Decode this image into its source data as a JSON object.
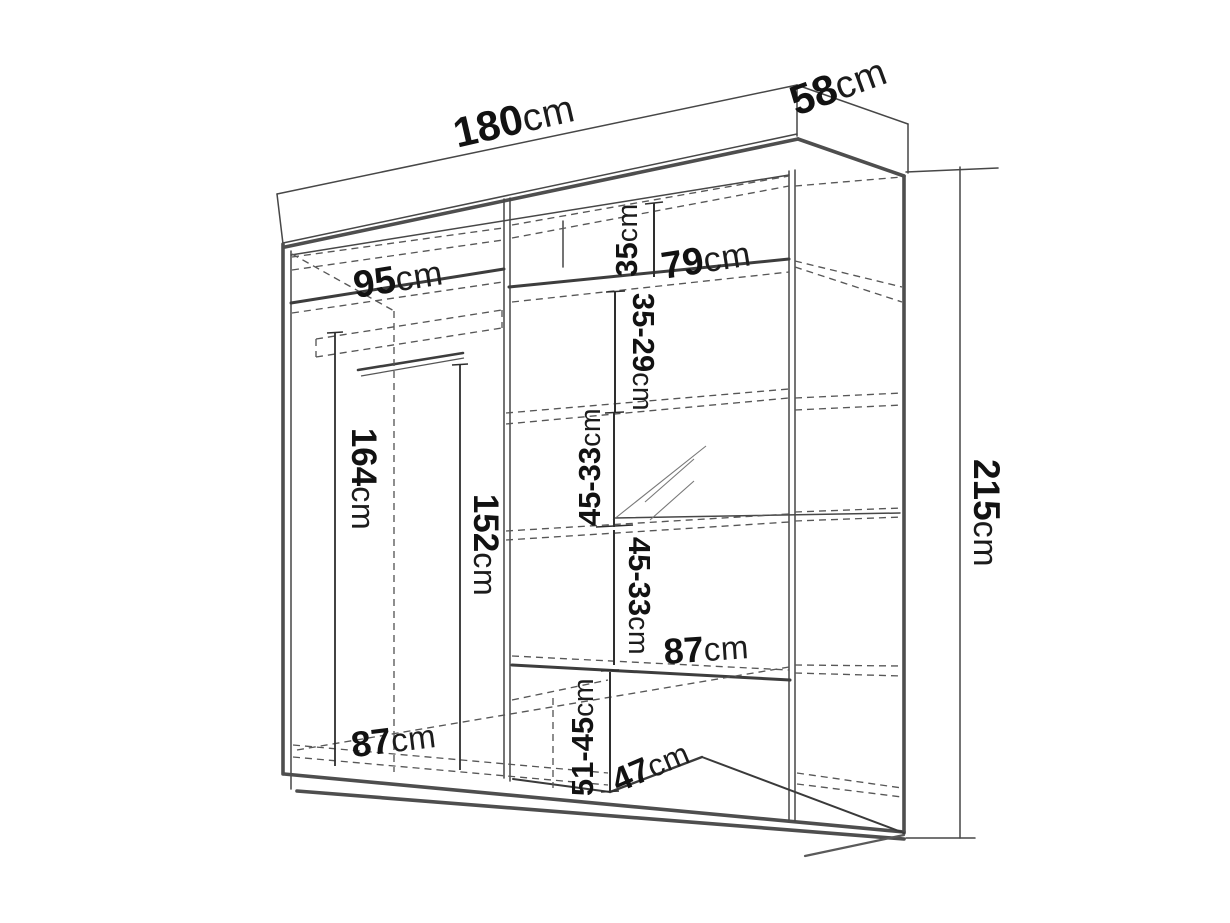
{
  "diagram": {
    "type": "wardrobe-dimension-drawing",
    "unit": "cm",
    "background_color": "#ffffff",
    "line_color": "#474747",
    "text_color": "#121212",
    "overall": {
      "width_cm": 180,
      "depth_cm": 58,
      "height_cm": 215
    },
    "labels": {
      "width": {
        "num": "180",
        "unit": "cm"
      },
      "depth": {
        "num": "58",
        "unit": "cm"
      },
      "height": {
        "num": "215",
        "unit": "cm"
      },
      "left_section_width": {
        "num": "95",
        "unit": "cm"
      },
      "top_shelf_width": {
        "num": "79",
        "unit": "cm"
      },
      "top_compartment_height": {
        "num": "35",
        "unit": "cm"
      },
      "shelf_gap_1": {
        "num": "35-29",
        "unit": "cm"
      },
      "shelf_gap_2": {
        "num": "45-33",
        "unit": "cm"
      },
      "shelf_gap_3": {
        "num": "45-33",
        "unit": "cm"
      },
      "hanging_height_left": {
        "num": "164",
        "unit": "cm"
      },
      "hanging_height_right": {
        "num": "152",
        "unit": "cm"
      },
      "right_shelf_width": {
        "num": "87",
        "unit": "cm"
      },
      "bottom_left_width": {
        "num": "87",
        "unit": "cm"
      },
      "bottom_compartment_height": {
        "num": "51-45",
        "unit": "cm"
      },
      "bottom_shelf_depth": {
        "num": "47",
        "unit": "cm"
      }
    }
  }
}
